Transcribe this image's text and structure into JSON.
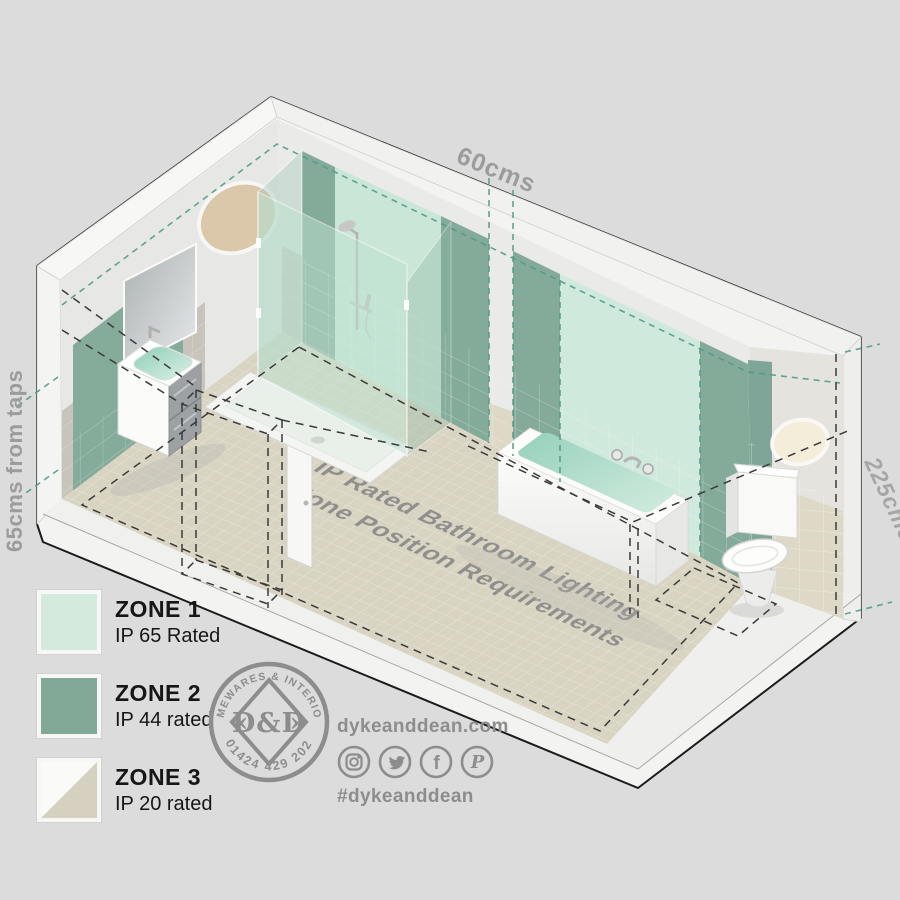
{
  "scene": {
    "dimension_labels": {
      "top": "60cms",
      "left": "65cms from taps",
      "right": "225cms"
    },
    "floor_text": {
      "line1": "IP Rated Bathroom Lighting",
      "line2": "Zone Position Requirements"
    }
  },
  "legend": {
    "zones": [
      {
        "name": "ZONE 1",
        "rating": "IP 65 Rated",
        "color": "#d3eadd",
        "color2": "#d3eadd"
      },
      {
        "name": "ZONE 2",
        "rating": "IP 44 rated",
        "color": "#82a998",
        "color2": "#82a998"
      },
      {
        "name": "ZONE 3",
        "rating": "IP 20 rated",
        "color": "#d6d0c0",
        "color2": "#fafaf8"
      }
    ]
  },
  "logo": {
    "arc_top": "HOMEWARES & INTERIORS",
    "arc_bottom": "01424 429 202",
    "monogram": "D&D",
    "arrow_left": "‹",
    "arrow_right": "›"
  },
  "social": {
    "website": "dykeanddean.com",
    "hashtag": "#dykeanddean",
    "icons": [
      "instagram-icon",
      "twitter-icon",
      "facebook-icon",
      "pinterest-icon"
    ]
  },
  "colors": {
    "background": "#dcdcdc",
    "zone1_mint": "#cfe9dc",
    "zone2_green": "#84aa99",
    "zone3_beige": "#d6d0c0",
    "floor_tile": "#d9d4c2",
    "teal_dash": "#4f9c89",
    "label_gray": "#9c9c9c",
    "logo_gray": "#8d8d8d"
  }
}
